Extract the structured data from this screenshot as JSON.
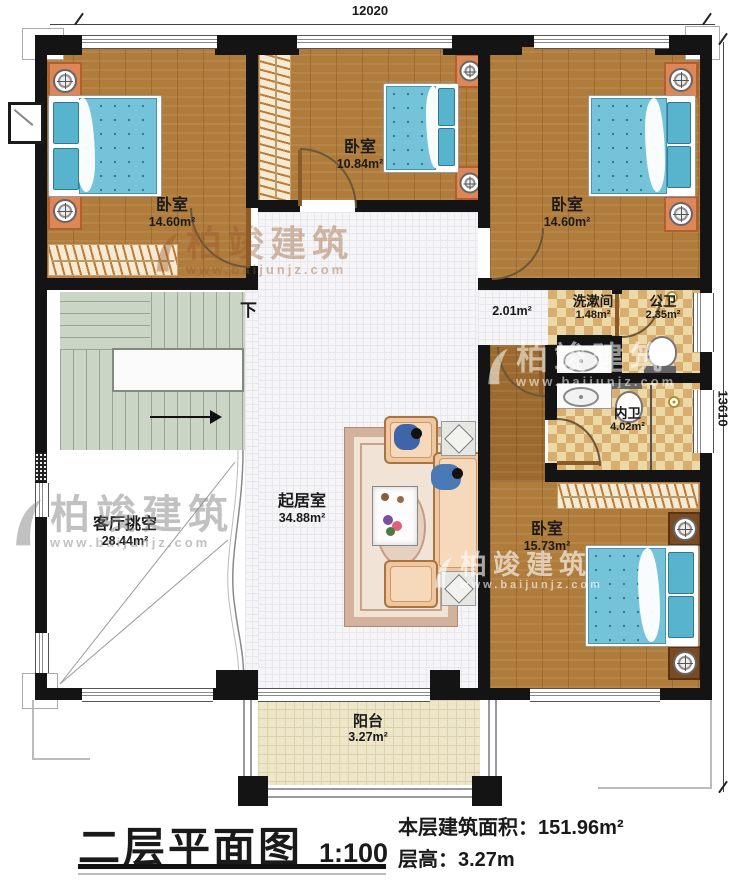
{
  "dimensions": {
    "width_top": "12020",
    "height_right": "13610"
  },
  "rooms": {
    "bedroom_top_left": {
      "name": "卧室",
      "area": "14.60m²"
    },
    "bedroom_top_middle": {
      "name": "卧室",
      "area": "10.84m²"
    },
    "bedroom_top_right": {
      "name": "卧室",
      "area": "14.60m²"
    },
    "bedroom_bottom_right": {
      "name": "卧室",
      "area": "15.73m²"
    },
    "living_room": {
      "name": "起居室",
      "area": "34.88m²"
    },
    "void": {
      "name": "客厅挑空",
      "area": "28.44m²"
    },
    "washroom": {
      "name": "洗漱间",
      "area": "1.48m²"
    },
    "public_bath": {
      "name": "公卫",
      "area": "2.35m²"
    },
    "private_bath": {
      "name": "内卫",
      "area": "4.02m²"
    },
    "balcony": {
      "name": "阳台",
      "area": "3.27m²"
    },
    "corridor": {
      "area": "2.01m²"
    }
  },
  "stairs": {
    "down": "下"
  },
  "title_block": {
    "title": "二层平面图",
    "scale": "1:100",
    "area_label": "本层建筑面积：",
    "area_value": "151.96m²",
    "height_label": "层高：",
    "height_value": "3.27m"
  },
  "watermark": {
    "brand": "柏竣建筑",
    "url": "www.baijunjz.com"
  },
  "colors": {
    "wall": "#141414",
    "wood": "#b07c3c",
    "tile": "#f5f5f7",
    "checker_light": "#ecd9a8",
    "checker_dark": "#d9ad6e",
    "stairs": "#cbd5c5",
    "balcony": "#eee6c9",
    "bed": "#74c3d8",
    "nightstand": "#dd8757",
    "watermark": "#965828"
  }
}
